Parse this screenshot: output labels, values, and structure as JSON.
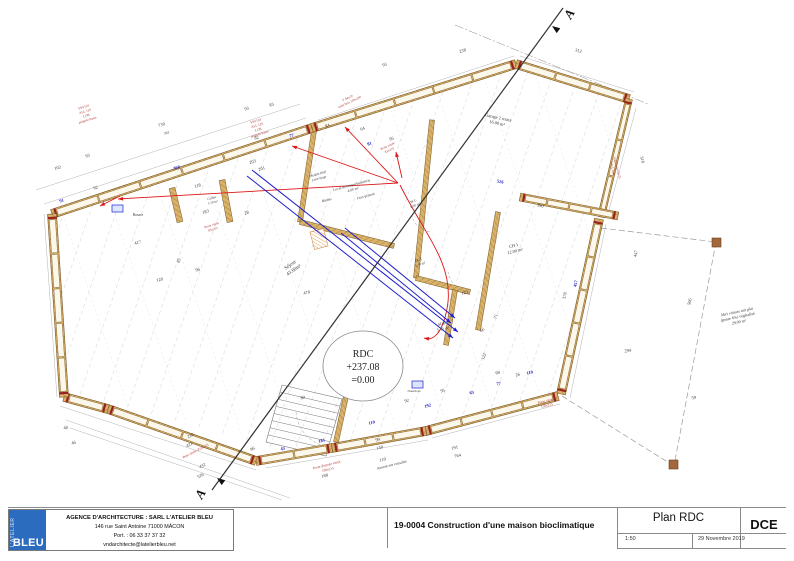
{
  "title_block": {
    "logo_vertical": "L'ATELIER",
    "logo_main": "BLEU",
    "agency_lines": [
      "AGENCE D'ARCHITECTURE : SARL L'ATELIER BLEU",
      "146 rue Saint Antoine 71000 MÂCON",
      "Port. : 06 33 37 37 32",
      "vndarchitecte@latelierbleu.net"
    ],
    "project": "19-0004 Construction d'une maison bioclimatique",
    "plan_title": "Plan RDC",
    "doc_type": "DCE",
    "scale": "1:50",
    "date": "29 Novembre 2019"
  },
  "colors": {
    "logo_blue": "#2b6cbf",
    "wall_tan": "#d9b36c",
    "wall_edge": "#7a5a28",
    "dim_blue": "#1d1dc8",
    "note_red": "#b03030",
    "line_red": "#dd1515",
    "line_blue": "#2020cc"
  },
  "plan": {
    "section_label": "A",
    "level_marker": {
      "lines": [
        "RDC",
        "+237.08",
        "=0.00"
      ]
    },
    "dims": [
      [
        "730",
        162,
        126,
        -17,
        "k",
        null
      ],
      [
        "361",
        167,
        134,
        -17,
        "k",
        3.8
      ],
      [
        "93",
        247,
        110,
        -17,
        "k",
        null
      ],
      [
        "83",
        272,
        106,
        -17,
        "k",
        null
      ],
      [
        "82",
        257,
        139,
        -17,
        "k",
        null
      ],
      [
        "92",
        96,
        189,
        -17,
        "k",
        null
      ],
      [
        "102",
        58,
        169,
        -17,
        "k",
        null
      ],
      [
        "93",
        88,
        157,
        -17,
        "k",
        null
      ],
      [
        "360",
        177,
        169,
        -17,
        "b",
        null
      ],
      [
        "77",
        292,
        137,
        -17,
        "b",
        null
      ],
      [
        "91",
        62,
        202,
        -17,
        "b",
        null
      ],
      [
        "203",
        253,
        163,
        -17,
        "k",
        null
      ],
      [
        "118",
        198,
        187,
        -17,
        "k",
        null
      ],
      [
        "201",
        262,
        170,
        -17,
        "k",
        null
      ],
      [
        "183",
        206,
        213,
        -17,
        "k",
        null
      ],
      [
        "28",
        247,
        214,
        -17,
        "k",
        null
      ],
      [
        "84",
        328,
        127,
        -20,
        "k",
        null
      ],
      [
        "64",
        363,
        130,
        -20,
        "k",
        null
      ],
      [
        "95",
        392,
        140,
        -20,
        "k",
        null
      ],
      [
        "81",
        370,
        145,
        -20,
        "b",
        null
      ],
      [
        "238",
        463,
        52,
        -17,
        "k",
        null
      ],
      [
        "93",
        385,
        66,
        -17,
        "k",
        null
      ],
      [
        "312",
        578,
        52,
        17,
        "k",
        null
      ],
      [
        "318",
        641,
        160,
        75,
        "k",
        null
      ],
      [
        "390",
        540,
        207,
        11,
        "k",
        null
      ],
      [
        "526",
        500,
        183,
        11,
        "b",
        null
      ],
      [
        "378",
        566,
        296,
        -78,
        "k",
        null
      ],
      [
        "457",
        577,
        284,
        -78,
        "b",
        null
      ],
      [
        "447",
        637,
        254,
        -78,
        "k",
        null
      ],
      [
        "506",
        691,
        302,
        -78,
        "k",
        null
      ],
      [
        "294",
        628,
        352,
        -8,
        "k",
        null
      ],
      [
        "59",
        694,
        399,
        -8,
        "k",
        null
      ],
      [
        "417",
        138,
        244,
        -15,
        "k",
        null
      ],
      [
        "120",
        160,
        281,
        -15,
        "k",
        null
      ],
      [
        "96",
        198,
        271,
        -15,
        "k",
        null
      ],
      [
        "478",
        307,
        294,
        -15,
        "k",
        null
      ],
      [
        "85",
        180,
        261,
        -70,
        "k",
        null
      ],
      [
        "216",
        191,
        437,
        -25,
        "k",
        null
      ],
      [
        "421",
        190,
        446,
        -25,
        "k",
        null
      ],
      [
        "432",
        203,
        467,
        -25,
        "k",
        null
      ],
      [
        "526",
        201,
        477,
        -25,
        "k",
        null
      ],
      [
        "96",
        253,
        450,
        -25,
        "k",
        null
      ],
      [
        "48",
        66,
        429,
        -15,
        "k",
        null
      ],
      [
        "46",
        74,
        444,
        -15,
        "k",
        null
      ],
      [
        "99",
        378,
        441,
        -14,
        "k",
        null
      ],
      [
        "140",
        380,
        449,
        -14,
        "k",
        null
      ],
      [
        "110",
        383,
        461,
        -14,
        "k",
        null
      ],
      [
        "188",
        325,
        477,
        -14,
        "k",
        null
      ],
      [
        "191",
        455,
        449,
        -14,
        "k",
        null
      ],
      [
        "764",
        458,
        457,
        -14,
        "k",
        null
      ],
      [
        "92",
        407,
        402,
        -14,
        "k",
        null
      ],
      [
        "95",
        443,
        392,
        -14,
        "k",
        null
      ],
      [
        "80",
        303,
        399,
        -14,
        "k",
        null
      ],
      [
        "43",
        283,
        450,
        -14,
        "b",
        null
      ],
      [
        "181",
        322,
        442,
        -14,
        "b",
        null
      ],
      [
        "110",
        372,
        424,
        -14,
        "b",
        null
      ],
      [
        "192",
        428,
        407,
        -14,
        "b",
        null
      ],
      [
        "63",
        472,
        394,
        -14,
        "b",
        null
      ],
      [
        "110",
        530,
        374,
        -14,
        "b",
        null
      ],
      [
        "77",
        499,
        385,
        -14,
        "b",
        null
      ],
      [
        "123",
        465,
        294,
        -14,
        "k",
        null
      ],
      [
        "71",
        497,
        317,
        -70,
        "k",
        null
      ],
      [
        "66",
        483,
        331,
        -40,
        "k",
        null
      ],
      [
        "122",
        485,
        357,
        -70,
        "k",
        null
      ],
      [
        "68",
        498,
        374,
        -14,
        "k",
        null
      ],
      [
        "26",
        518,
        376,
        -14,
        "k",
        null
      ]
    ],
    "labels": [
      {
        "ls": [
          "Séjour",
          "43.60m²"
        ],
        "x": 291,
        "y": 266,
        "r": -35,
        "s": 5,
        "c": "k"
      },
      {
        "ls": [
          "Garage 2 roues",
          "16.00 m²"
        ],
        "x": 498,
        "y": 119,
        "r": 12,
        "s": 4.4,
        "c": "k"
      },
      {
        "ls": [
          "CH 1",
          "12.00 m²"
        ],
        "x": 514,
        "y": 247,
        "r": -14,
        "s": 4.4,
        "c": "k"
      },
      {
        "ls": [
          "SDB",
          "5.10 m²"
        ],
        "x": 442,
        "y": 325,
        "r": -14,
        "s": 4,
        "c": "k"
      },
      {
        "ls": [
          "W.C.",
          "1.90 m²"
        ],
        "x": 414,
        "y": 202,
        "r": -20,
        "s": 3.5,
        "c": "k"
      },
      {
        "ls": [
          "DGT",
          "1.70 m²"
        ],
        "x": 419,
        "y": 261,
        "r": -20,
        "s": 3.5,
        "c": "k"
      },
      {
        "ls": [
          "Local technique/buanderie",
          "4.80 m²"
        ],
        "x": 352,
        "y": 186,
        "r": -15,
        "s": 3.6,
        "c": "k"
      },
      {
        "ls": [
          "Faux-plafond"
        ],
        "x": 366,
        "y": 197,
        "r": -15,
        "s": 3.4,
        "c": "k"
      },
      {
        "ls": [
          "Meuble HSP",
          "Lave-linge"
        ],
        "x": 318,
        "y": 175,
        "r": -15,
        "s": 3.4,
        "c": "k"
      },
      {
        "ls": [
          "Bûches"
        ],
        "x": 327,
        "y": 201,
        "r": -15,
        "s": 3.4,
        "c": "k"
      },
      {
        "ls": [
          "Cellier",
          "1.50 m²"
        ],
        "x": 212,
        "y": 199,
        "r": -15,
        "s": 3.3,
        "c": "k"
      },
      {
        "ls": [
          "Rosace"
        ],
        "x": 138,
        "y": 216,
        "r": 0,
        "s": 3.6,
        "c": "k"
      },
      {
        "ls": [
          "Nourrices"
        ],
        "x": 414,
        "y": 392,
        "r": 0,
        "s": 3.3,
        "c": "k"
      },
      {
        "ls": [
          "Abri voiture toit plat",
          "(pente 4%) végétalisé",
          "29.00 m²"
        ],
        "x": 737,
        "y": 313,
        "r": -12,
        "s": 4,
        "c": "k"
      },
      {
        "ls": [
          "Auvent sur consoles"
        ],
        "x": 392,
        "y": 466,
        "r": -14,
        "s": 3.8,
        "c": "k"
      },
      {
        "ls": [
          "F93/103",
          "ALL 120",
          "LOB",
          "poignée basse"
        ],
        "x": 84,
        "y": 108,
        "r": -17,
        "s": 3.3,
        "c": "r"
      },
      {
        "ls": [
          "F93/103",
          "ALL 120",
          "LOB",
          "poignée basse"
        ],
        "x": 256,
        "y": 122,
        "r": -17,
        "s": 3.3,
        "c": "r"
      },
      {
        "ls": [
          "F 64x70",
          "volet bois 100x200"
        ],
        "x": 348,
        "y": 99,
        "r": -25,
        "s": 3.3,
        "c": "r"
      },
      {
        "ls": [
          "Porte vitrée",
          "83x215"
        ],
        "x": 388,
        "y": 147,
        "r": -25,
        "s": 3.3,
        "c": "r"
      },
      {
        "ls": [
          "Porte vitrée",
          "83x215"
        ],
        "x": 212,
        "y": 226,
        "r": -17,
        "s": 3.3,
        "c": "r"
      },
      {
        "ls": [
          "Porte vitrée",
          "150x215"
        ],
        "x": 546,
        "y": 402,
        "r": -14,
        "s": 3.5,
        "c": "r"
      },
      {
        "ls": [
          "Porte d'entrée vitrée",
          "190x215"
        ],
        "x": 327,
        "y": 466,
        "r": -14,
        "s": 3.5,
        "c": "r"
      },
      {
        "ls": [
          "Baie vitrée 452x215"
        ],
        "x": 196,
        "y": 452,
        "r": -27,
        "s": 3.5,
        "c": "r"
      },
      {
        "ls": [
          "Volet bois 60x75",
          "ALL 120"
        ],
        "x": 616,
        "y": 168,
        "r": 75,
        "s": 3.3,
        "c": "r"
      }
    ]
  }
}
